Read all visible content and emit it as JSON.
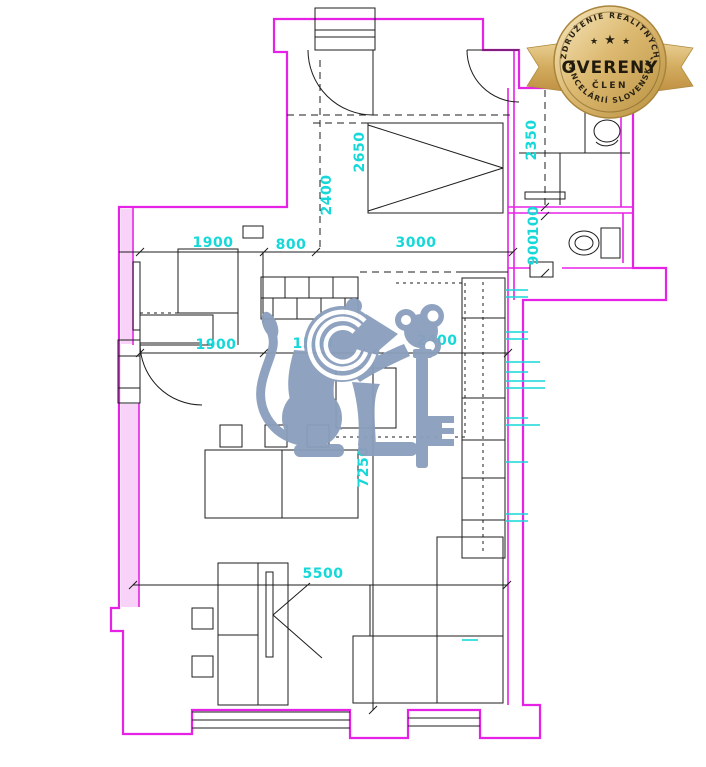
{
  "badge": {
    "arc_top": "ZDRUŽENIE REALITNÝCH",
    "arc_bottom": "KANCELÁRIÍ SLOVENSKA",
    "title": "OVERENÝ",
    "subtitle": "ČLEN",
    "star": "★"
  },
  "dims": {
    "hall_a": "1900",
    "hall_b": "800",
    "bedroom_w": "3000",
    "bedroom_d": "2650",
    "bedroom_h": "2400",
    "bath_d": "2350",
    "wc_a": "100",
    "wc_b": "900",
    "living_a": "1900",
    "living_b": "1500",
    "living_c": "2400",
    "living_depth": "7250",
    "living_w": "5500"
  },
  "colors": {
    "wall": "#e522e5",
    "dim_text": "#16d8d8",
    "watermark": "#8b9fbd",
    "badge_gold": "#c79d4c",
    "lines": "#1c1c1c"
  }
}
